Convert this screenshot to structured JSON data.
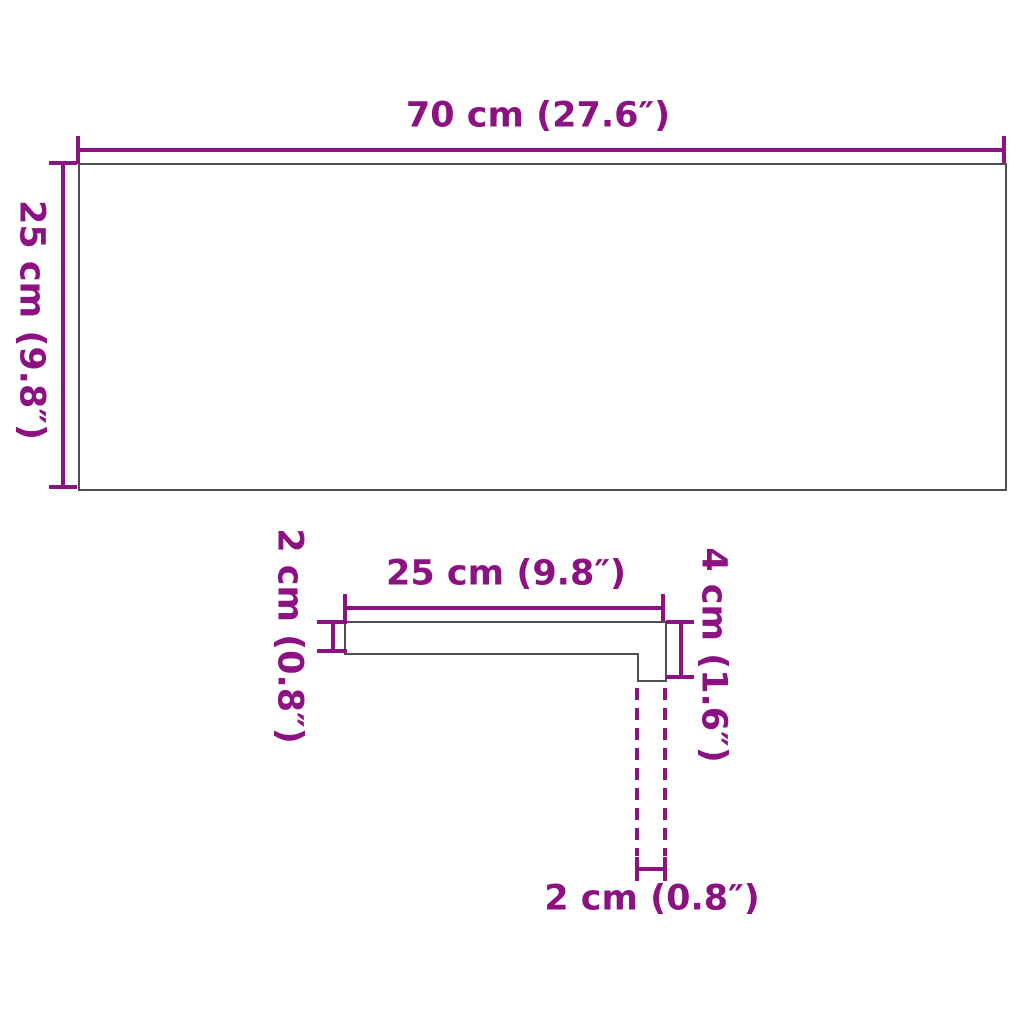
{
  "colors": {
    "accent": "#8C1282",
    "outline": "#4F4F4F",
    "bg": "#FFFFFF"
  },
  "top_view": {
    "width_label": "70 cm (27.6″)",
    "height_label": "25 cm (9.8″)"
  },
  "profile_view": {
    "depth_label": "25 cm (9.8″)",
    "thickness_label": "2 cm (0.8″)",
    "front_edge_height_label": "4 cm (1.6″)",
    "front_edge_thickness_label": "2 cm (0.8″)"
  }
}
